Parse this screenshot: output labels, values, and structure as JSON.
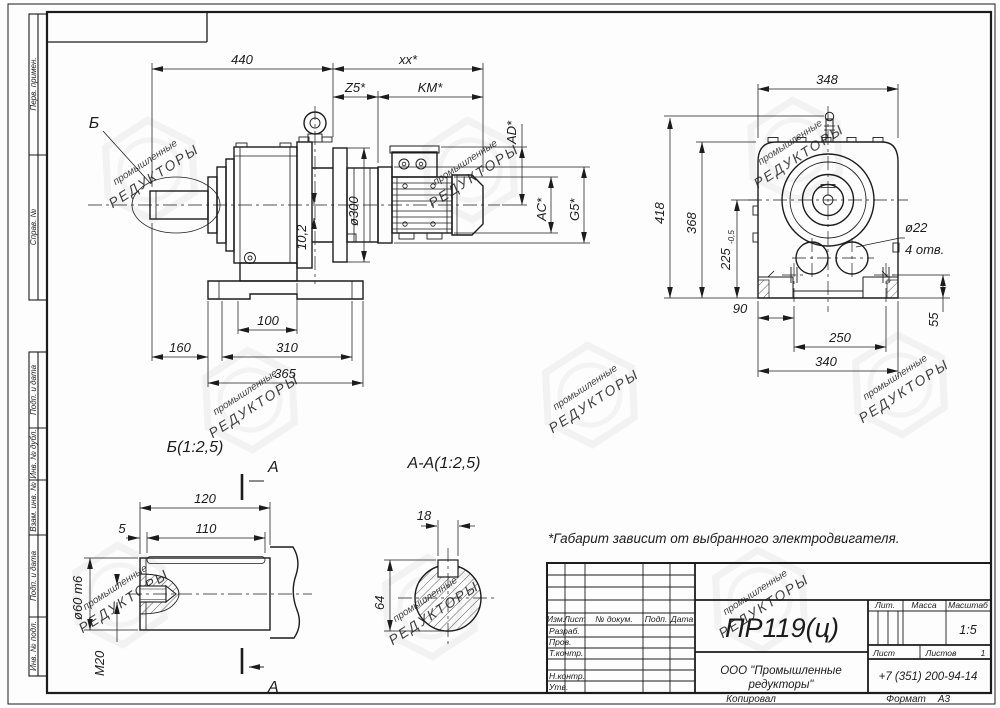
{
  "watermark": {
    "line1": "промышленные",
    "line2": "РЕДУКТОРЫ"
  },
  "frame": {
    "left_stamps_top": [
      "Перв. примен.",
      "Справ. №"
    ],
    "left_stamps_bottom": [
      "Подп. и дата",
      "Инв. № дубл.",
      "Взам. инв. №",
      "Подп. и дата",
      "Инв. № подл."
    ],
    "footer": {
      "copied": "Копировал",
      "format_label": "Формат",
      "format_value": "А3"
    }
  },
  "note": "*Габарит зависит от выбранного электродвигателя.",
  "main_view": {
    "detail_label": "Б",
    "dims": {
      "overall": "440",
      "motor_overall": "xx*",
      "z5": "Z5*",
      "km": "KM*",
      "ad": "AD*",
      "ac": "AC*",
      "g5": "G5*",
      "flange_dia": "ø300",
      "offset": "10,2",
      "foot_a": "100",
      "foot_b": "310",
      "foot_c": "365",
      "shaft_len": "160"
    }
  },
  "front_view": {
    "dims": {
      "width_top": "348",
      "height_total": "418",
      "height_body": "368",
      "axis_height": "225",
      "axis_tol": "-0,5",
      "hole_dia": "ø22",
      "hole_count": "4 отв.",
      "foot_offset": "90",
      "hole_pitch": "250",
      "base_width": "340",
      "edge": "55"
    }
  },
  "detail_b": {
    "title": "Б(1:2,5)",
    "section_label": "А",
    "dims": {
      "length": "120",
      "key_length": "110",
      "key_offset": "5",
      "dia": "ø60 m6",
      "thread": "М20"
    }
  },
  "section_aa": {
    "title": "А-А(1:2,5)",
    "dims": {
      "key_width": "18",
      "key_height": "64"
    }
  },
  "title_block": {
    "doc_number": "ПР119(ц)",
    "header": {
      "izm": "Изм.",
      "list": "Лист",
      "doc": "№ докум.",
      "sign": "Подп.",
      "date": "Дата"
    },
    "rows": {
      "razrab": "Разраб.",
      "prov": "Пров.",
      "tkontr": "Т.контр.",
      "nkontr": "Н.контр.",
      "utv": "Утв."
    },
    "lit_label": "Лит.",
    "mass_label": "Масса",
    "scale_label": "Масштаб",
    "scale_value": "1:5",
    "sheet_label": "Лист",
    "sheets_label": "Листов",
    "sheets_value": "1",
    "company_line1": "ООО \"Промышленные",
    "company_line2": "редукторы\"",
    "phone": "+7 (351) 200-94-14"
  }
}
